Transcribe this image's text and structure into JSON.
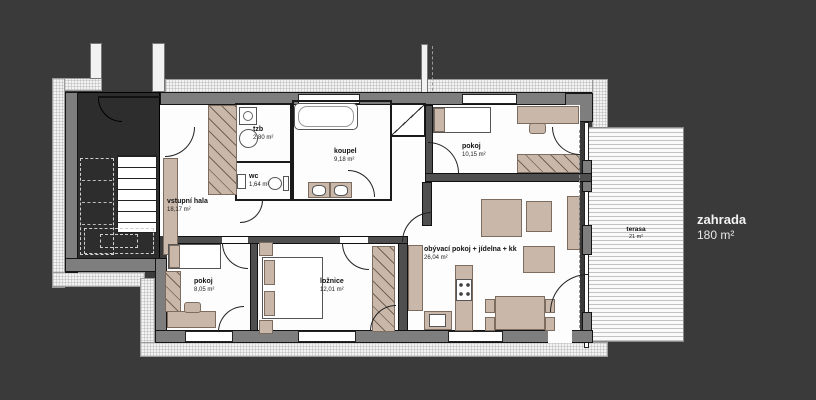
{
  "rooms": {
    "vstupni_hala": {
      "name": "vstupní hala",
      "area": "18,17 m²"
    },
    "tzb": {
      "name": "tzb",
      "area": "2,80 m²"
    },
    "wc": {
      "name": "wc",
      "area": "1,64 m²"
    },
    "koupelna": {
      "name": "koupel",
      "area": "9,18 m²"
    },
    "pokoj_sever": {
      "name": "pokoj",
      "area": "10,15 m²"
    },
    "pokoj_jih": {
      "name": "pokoj",
      "area": "8,05 m²"
    },
    "loznice": {
      "name": "ložnice",
      "area": "12,01 m²"
    },
    "obyvak": {
      "name": "obývací pokoj + jídelna + kk",
      "area": "26,04 m²"
    },
    "terasa": {
      "name": "terasa",
      "area": "21 m²"
    },
    "zahrada": {
      "name": "zahrada",
      "area": "180 m²"
    }
  },
  "colors": {
    "background": "#3a3a3a",
    "exterior_wall": "#7e7e7e",
    "interior_wall": "#4f4f4f",
    "stairwell": "#2d2d2d",
    "furniture": "#c9b7a9",
    "floor": "#fdfdfd"
  }
}
